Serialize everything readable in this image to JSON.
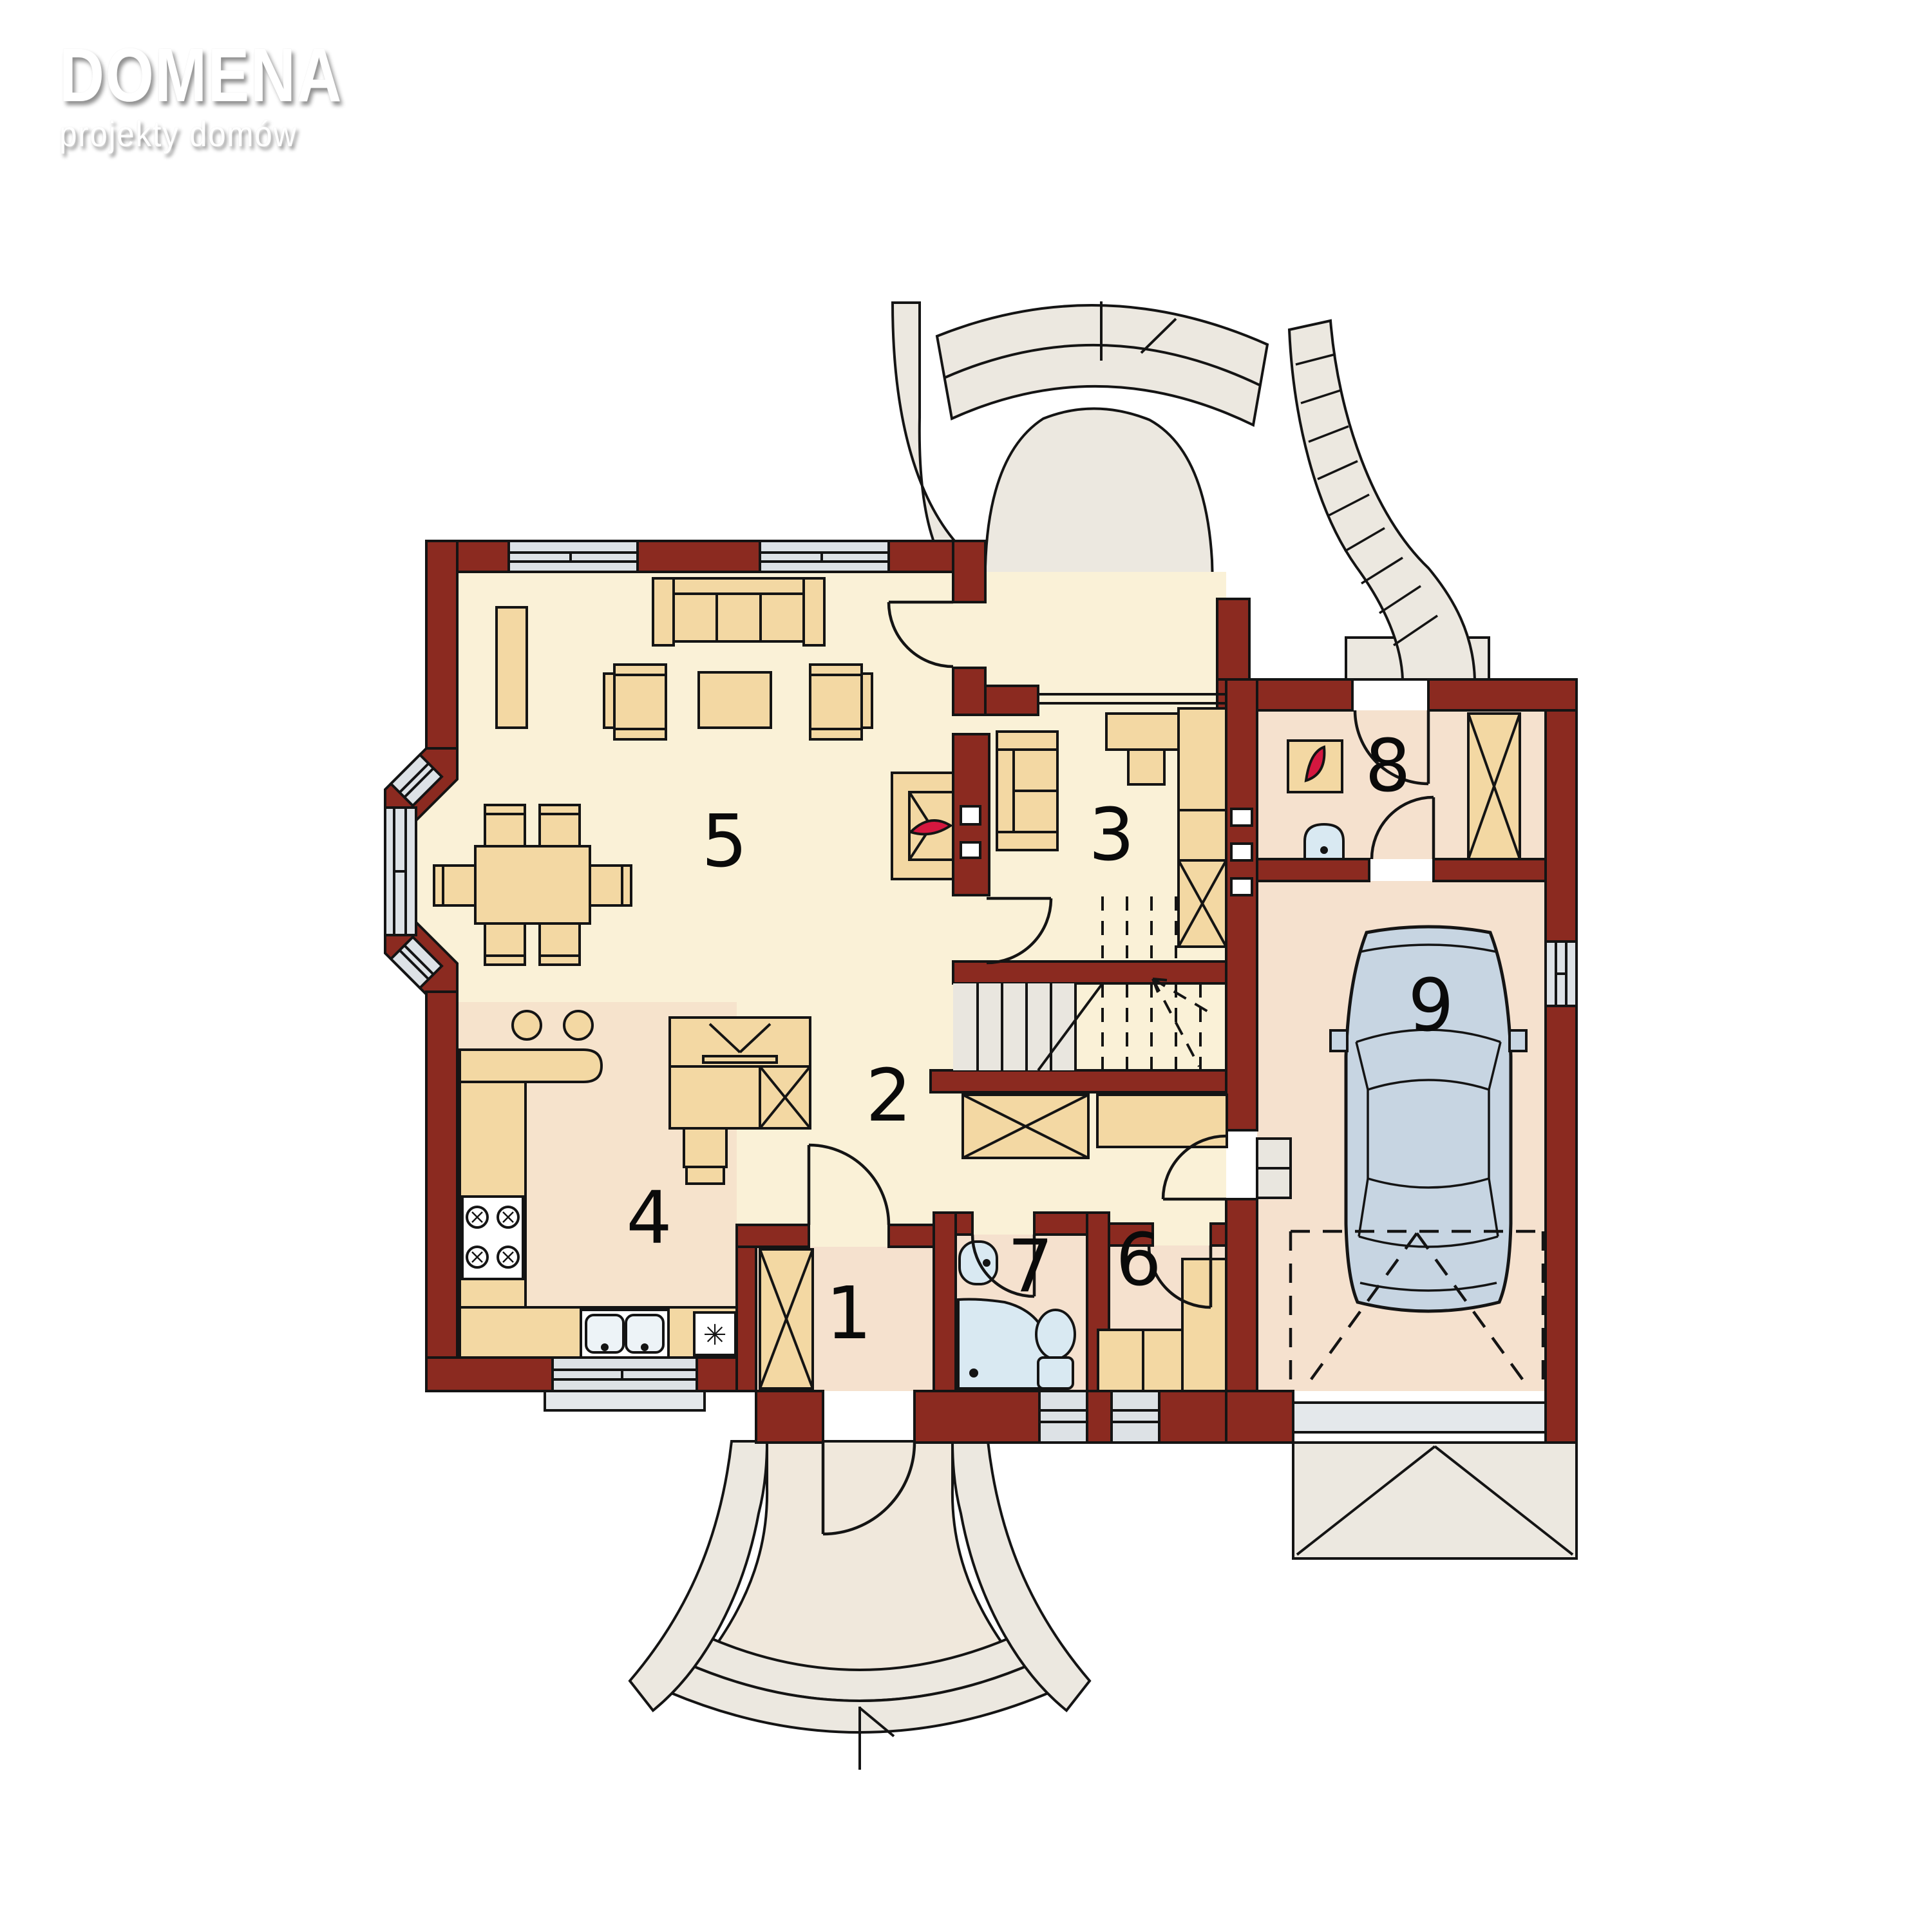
{
  "logo": {
    "title": "DOMENA",
    "subtitle": "projekty domów"
  },
  "plan": {
    "rooms": [
      {
        "number": "1"
      },
      {
        "number": "2"
      },
      {
        "number": "3"
      },
      {
        "number": "4"
      },
      {
        "number": "5"
      },
      {
        "number": "6"
      },
      {
        "number": "7"
      },
      {
        "number": "8"
      },
      {
        "number": "9"
      }
    ],
    "freezer_symbol": "✳"
  },
  "colors": {
    "wall": "#8B2A20",
    "outline": "#141414",
    "room_cream": "#FAF1D7",
    "room_kitchen": "#F6E3CC",
    "room_peach": "#F5E1CE",
    "furniture_tan": "#F3D8A3",
    "exterior_gray": "#ECE8E0",
    "terrace_floor": "#F0E8DC",
    "window_glass": "#DDE2E6",
    "fixture_blue": "#D9E9F2",
    "flame_red": "#D4173F",
    "car_body": "#C7D5E2"
  }
}
